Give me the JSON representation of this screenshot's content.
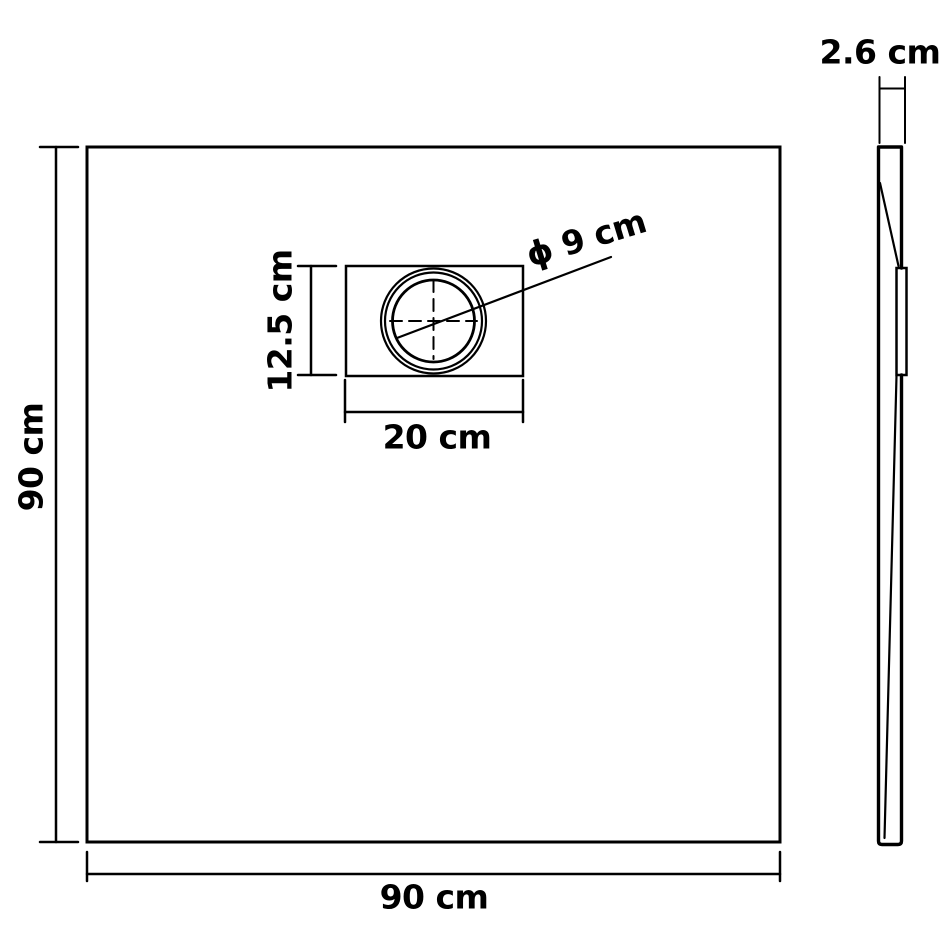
{
  "diagram": {
    "type": "technical-dimension-drawing",
    "subject": "square shower base tray, top view with drain and side profile",
    "colors": {
      "line": "#000000",
      "background": "#ffffff"
    },
    "top_view": {
      "height_label": "90 cm",
      "width_label": "90 cm",
      "drain_box_width_label": "20 cm",
      "drain_box_height_label": "12.5 cm",
      "drain_diameter_label": "ϕ 9 cm"
    },
    "side_view": {
      "thickness_label": "2.6 cm"
    }
  }
}
